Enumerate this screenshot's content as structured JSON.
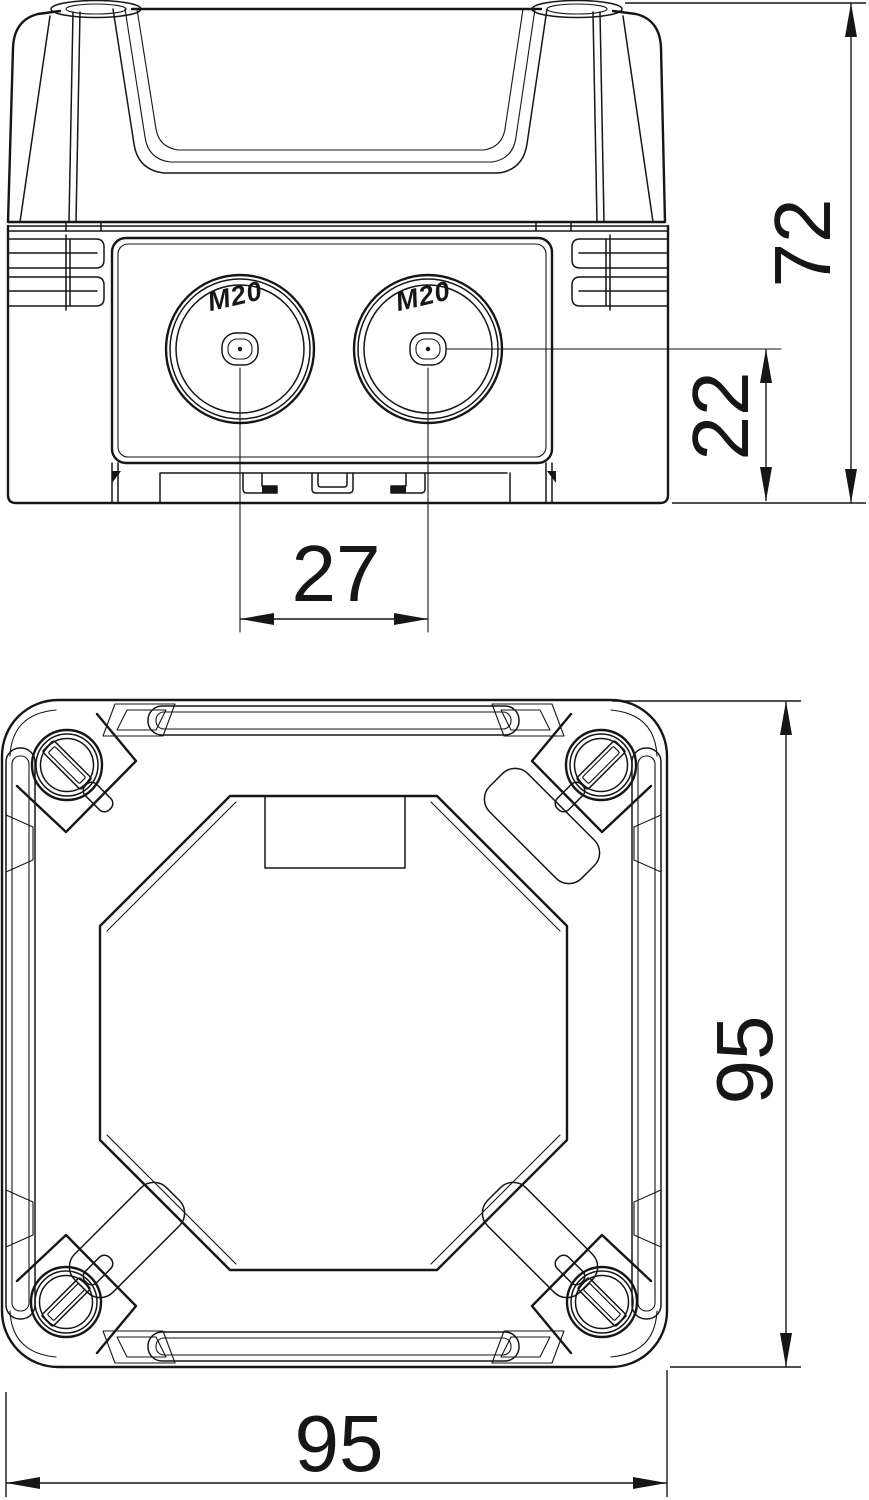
{
  "drawing": {
    "type": "technical-dimension-drawing",
    "line_color": "#161616",
    "background": "#ffffff",
    "side_view": {
      "knockouts": [
        {
          "label": "M20"
        },
        {
          "label": "M20"
        }
      ],
      "dimensions": {
        "overall_height": "72",
        "entry_center_height": "22",
        "entry_spacing": "27"
      }
    },
    "bottom_view": {
      "dimensions": {
        "overall_width": "95",
        "overall_depth": "95"
      }
    }
  }
}
